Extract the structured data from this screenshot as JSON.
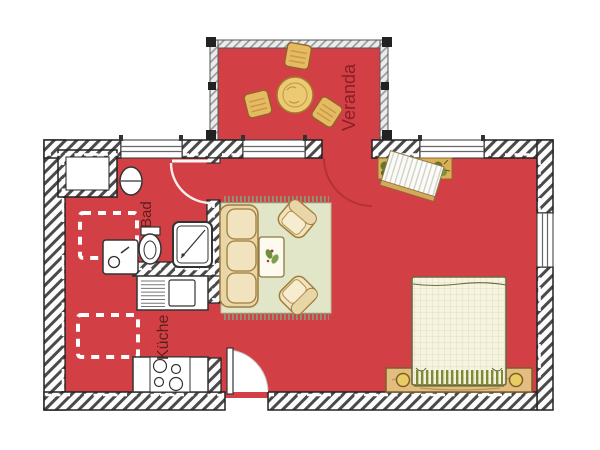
{
  "title": "Apartment floor plan",
  "labels": {
    "veranda": "Veranda",
    "bad": "Bad",
    "kueche": "Küche"
  },
  "rooms": [
    {
      "name": "veranda",
      "label": "Veranda"
    },
    {
      "name": "bathroom",
      "label": "Bad"
    },
    {
      "name": "kitchen",
      "label": "Küche"
    },
    {
      "name": "living-sleeping-room"
    }
  ],
  "fixtures": [
    "closet",
    "washbasin",
    "washing-machine",
    "toilet",
    "shower",
    "kitchen-sink-counter",
    "stove",
    "dining-table",
    "dining-chair",
    "sofa",
    "coffee-table",
    "armchair",
    "rug",
    "desk",
    "plant",
    "double-bed",
    "entrance-door",
    "bathroom-door",
    "veranda-door",
    "window"
  ],
  "colors": {
    "floor_red": "#d24046",
    "wall_line": "#2f2f2f",
    "veranda_wall": "#9a9a9a",
    "label_maroon": "#5c1f1c",
    "label_veranda": "#8a1f24",
    "furniture_tan": "#e5ba62",
    "cushion_cream": "#f1e3bd",
    "rug_green": "#e1e6c8",
    "bed_linen": "#f6f3e1",
    "fringe_green": "#7d8b36",
    "door_swing_red": "#b23238"
  }
}
